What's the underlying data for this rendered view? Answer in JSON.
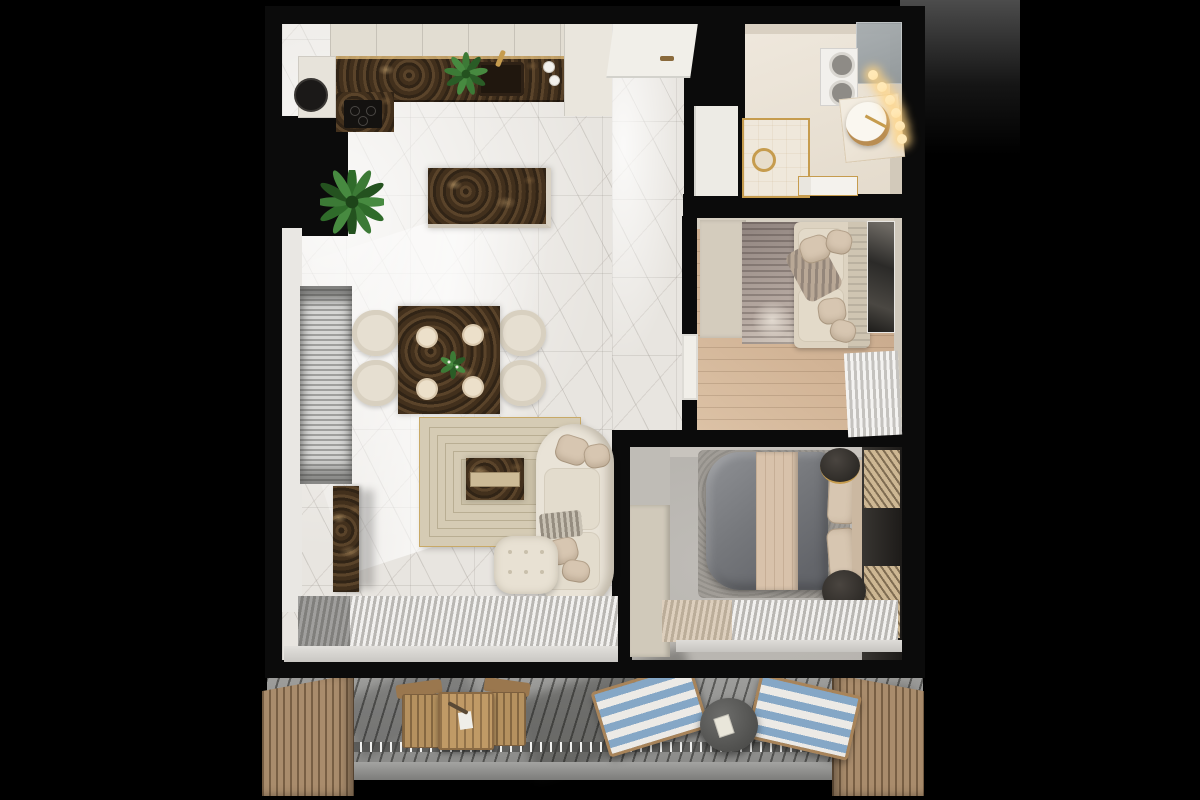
{
  "scene": {
    "title": "top-down-3d-apartment-floor-plan-render",
    "view": "overhead",
    "text_content": "none"
  },
  "palette": {
    "bg": "#000000",
    "wall": "#0b0b0b",
    "marbleFloor": "#e8e5e0",
    "marbleVein": "#a9a49c",
    "cream": "#e2ddd2",
    "creamDark": "#cfc8ba",
    "darkMarble": "#46331f",
    "darkMarbleHi": "#8a6b42",
    "gold": "#c69c4e",
    "woodFloor": "#c6a88a",
    "grayFloor": "#b6b3ae",
    "grayRug": "#a19d97",
    "duvet": "#76787c",
    "runner": "#d8c2ab",
    "pillow": "#d7c6b1",
    "sofa": "#e9e3d7",
    "sofaShade": "#cfc5b2",
    "rugBeige": "#d5cbb4",
    "rugLine": "#b9ae93",
    "blind": "#b9b9b7",
    "curtain": "#d8d6d2",
    "deck": "#949492",
    "screenWood": "#a98c6c",
    "loungerBlue": "#85a7c6",
    "loungerWhite": "#eceae6",
    "bistroWood": "#b5915f",
    "plantGreen": "#3c7a36",
    "plantDark": "#2a5c26",
    "artDark": "#2b2a28",
    "glass": "#a7adb0",
    "doorWhite": "#f1efe9"
  },
  "rooms": [
    {
      "name": "kitchen",
      "furniture": [
        "upper-cabinets",
        "tall-cabinet",
        "fridge-column",
        "dark-marble-countertop",
        "sink",
        "gold-faucet",
        "cooktop",
        "range-hood",
        "kitchen-island",
        "herb-plant",
        "dishes"
      ]
    },
    {
      "name": "living-dining",
      "furniture": [
        "dining-table",
        "dining-chair",
        "place-setting",
        "centerpiece-plant",
        "area-rug",
        "coffee-table",
        "curved-sofa",
        "throw-pillow",
        "ottoman",
        "tv-console",
        "floor-plant",
        "window-blinds",
        "sheer-curtain",
        "window-sill"
      ]
    },
    {
      "name": "entry-hall",
      "furniture": [
        "front-door",
        "shoe-cabinet"
      ]
    },
    {
      "name": "bathroom",
      "furniture": [
        "glass-shower",
        "washer-dryer-stack",
        "vanity-basin",
        "gold-faucet",
        "vanity-lights",
        "gold-framed-shower",
        "shower-head",
        "storage-console"
      ]
    },
    {
      "name": "guest-room",
      "furniture": [
        "wardrobe",
        "area-rug",
        "corner-sofa",
        "throw-pillow",
        "wall-art",
        "sheer-curtain",
        "interior-door"
      ]
    },
    {
      "name": "bedroom",
      "furniture": [
        "wardrobe",
        "double-bed",
        "duvet",
        "bed-runner",
        "pillows",
        "headboard-bench",
        "nightstand",
        "wood-slat-panel",
        "area-rug",
        "sheer-curtain",
        "window-sill"
      ]
    },
    {
      "name": "balcony",
      "furniture": [
        "privacy-screen-left",
        "privacy-screen-right",
        "bistro-table",
        "bistro-chair",
        "striped-lounger",
        "side-table",
        "deck-boards"
      ]
    }
  ]
}
